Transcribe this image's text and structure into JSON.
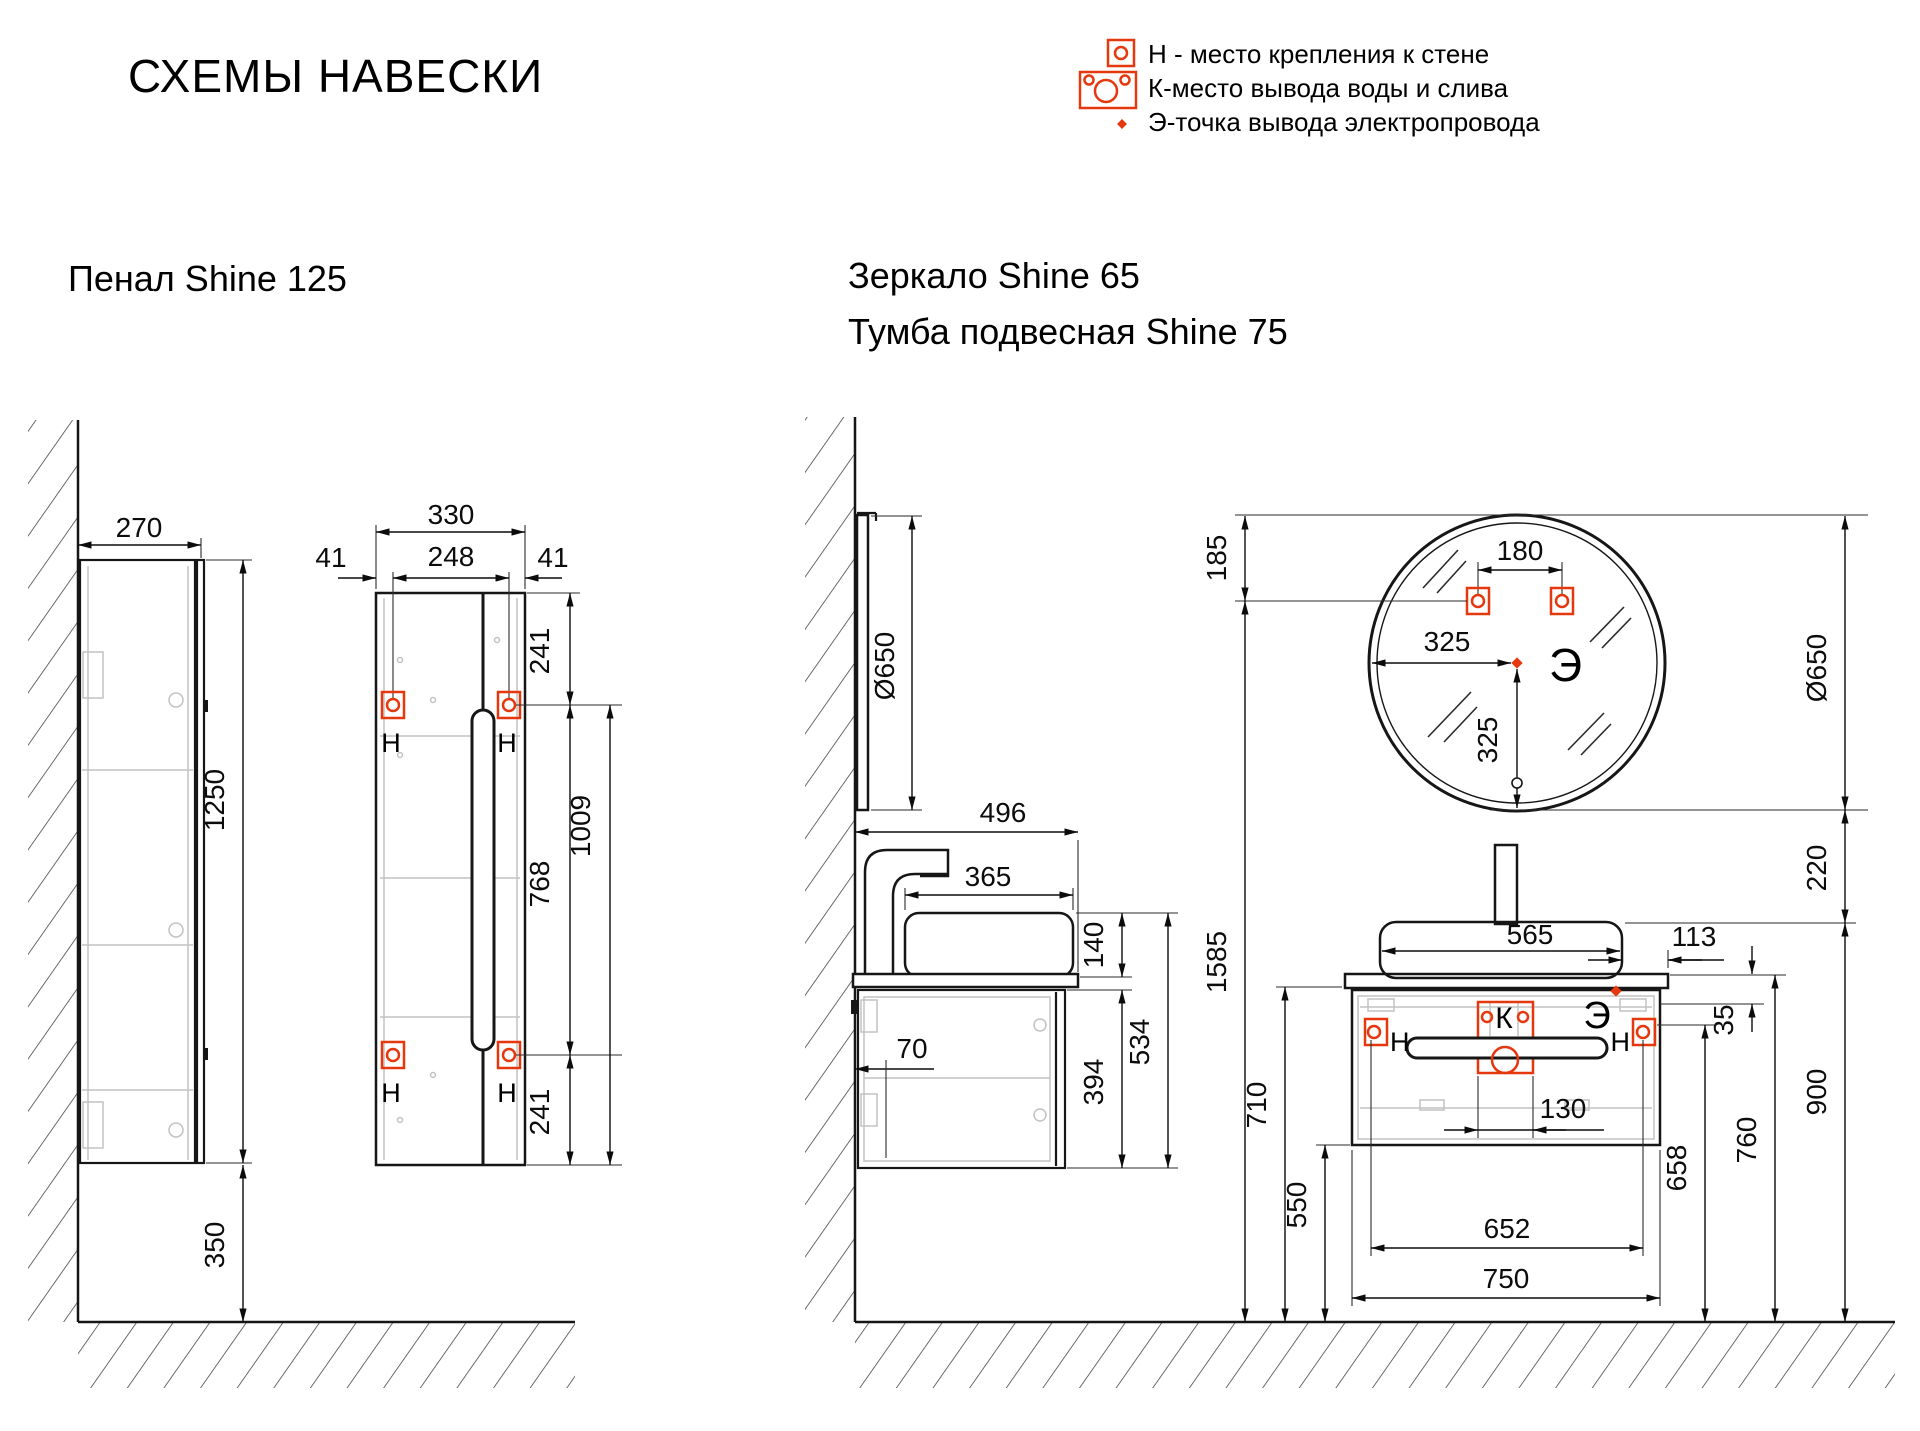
{
  "header": {
    "title": "СХЕМЫ НАВЕСКИ"
  },
  "legend": {
    "h": "Н - место крепления к стене",
    "k": "К-место вывода воды и слива",
    "e": "Э-точка вывода электропровода"
  },
  "colors": {
    "accent": "#e5380e"
  },
  "sections": {
    "penal": {
      "title": "Пенал Shine 125"
    },
    "mirror_vanity": {
      "title1": "Зеркало Shine 65",
      "title2": "Тумба подвесная Shine 75"
    }
  },
  "markers": {
    "h": "Н",
    "k": "К",
    "e": "Э"
  },
  "dims": {
    "penal_side": {
      "depth": "270",
      "height": "1250",
      "floor_gap": "350"
    },
    "penal_front": {
      "width": "330",
      "margin_l": "41",
      "inner": "248",
      "margin_r": "41",
      "top_offset": "241",
      "bracket_span": "768",
      "bottom_offset": "241",
      "bracket_to_bottom": "1009"
    },
    "vanity_side": {
      "mirror_d": "Ø650",
      "counter_depth": "496",
      "sink_depth": "365",
      "sink_h": "140",
      "total_h": "534",
      "cab_h": "394",
      "wall_gap": "70"
    },
    "mirror_front": {
      "top_offset": "185",
      "bracket_span": "180",
      "center_x": "325",
      "center_y": "325",
      "dia": "Ø650",
      "gap_to_sink": "220"
    },
    "vanity_front": {
      "sink_w": "565",
      "right_offset": "113",
      "counter_to_mount": "35",
      "drain_w": "130",
      "bracket_span": "652",
      "cab_w": "750",
      "mount_h": "658",
      "counter_h": "760",
      "sink_rim_h": "900",
      "mirror_mount_h": "1585",
      "counter_bottom_h": "710",
      "cab_bottom_h": "550"
    }
  }
}
